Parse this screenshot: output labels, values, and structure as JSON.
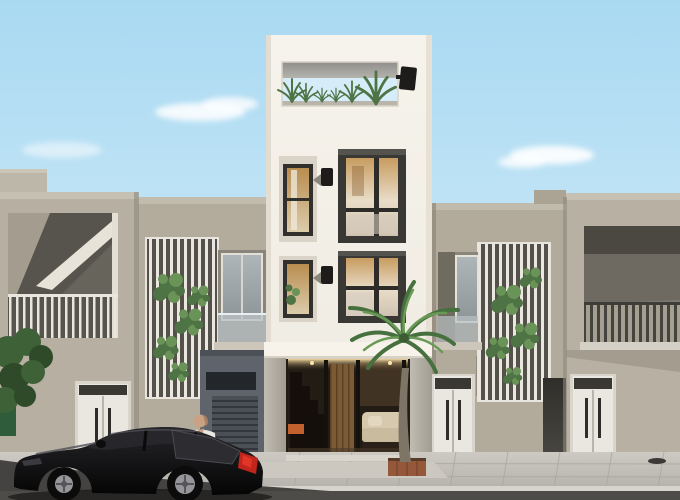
{
  "scene": {
    "type": "architectural-exterior-render",
    "alt_text": "Daytime 3D rendering of a narrow four-storey modern white townhouse with a rooftop garden opening, two dark bay windows, and a glazed ground-floor entrance, flanked by two-storey beige houses with vertical slat screens covered in climbing vines and balconies. A palm tree stands by the entrance, a man in a white shirt stands behind a black hatchback car parked on the street in the left foreground.",
    "objects": [
      "sky",
      "clouds",
      "far-left-house",
      "left-middle-house",
      "central-tower",
      "right-middle-house",
      "far-right-house",
      "roof-terrace",
      "bay-windows",
      "wall-lamps",
      "slat-screens",
      "climbing-vines",
      "balconies",
      "entry-doors",
      "entrance-glass-wall",
      "interior-staircase",
      "interior-sofa",
      "palm-tree",
      "street-tree",
      "waste-bin",
      "sidewalk",
      "road",
      "black-hatchback-car",
      "person"
    ]
  },
  "colors": {
    "sky-top": "#a9d9f2",
    "sky-mid": "#c6e6f6",
    "sky-low": "#e4f2f9",
    "cloud": "#ffffff",
    "tower-face": "#f4f1ea",
    "tower-shade": "#e0dbce",
    "wall-a": "#b7b0a2",
    "wall-b": "#b3ac9d",
    "wall-c": "#b2ab9c",
    "wall-d": "#b8b1a3",
    "roof-slab": "#c6c0b2",
    "recess-dark": "#57544d",
    "trim-white": "#e9e6df",
    "frame-dark": "#32302c",
    "door-white": "#eae7e0",
    "transom-dark": "#393833",
    "vine-green": "#4e7345",
    "vine-green2": "#699357",
    "lamp-black": "#1d1c1a",
    "seam": "#8e887b",
    "ground-dark": "#5f646c",
    "pillar-concrete": "#b6b2a8",
    "interior-dark": "#221c15",
    "wood": "#7c5a36",
    "sofa": "#d7c9ad",
    "glow": "#f0d49a",
    "glass-warm": "#c3985e",
    "glass-cool": "#9fa8ab",
    "sidewalk": "#c8c5be",
    "curb": "#d7d4cd",
    "road": "#4e4c48",
    "car-black": "#0e0e0e",
    "taillight": "#c1251b",
    "wheel-rim": "#95959a",
    "skin": "#c9a183",
    "shirt": "#e9e7e2",
    "palm-green": "#47703f",
    "palm-green2": "#699a55",
    "palm-trunk": "#7d7666",
    "planter": "#95583a",
    "bin-green": "#2f5c3b",
    "tree-green": "#3f6138",
    "tree-green2": "#2e4a29"
  }
}
